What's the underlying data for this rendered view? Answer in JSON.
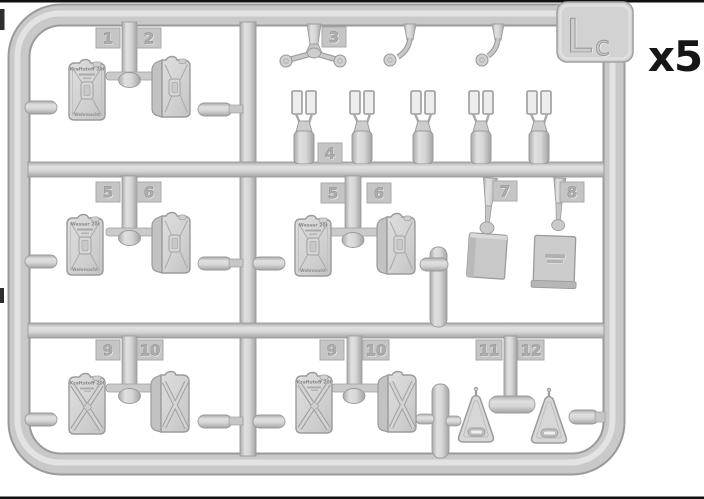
{
  "sprue": {
    "code_main": "L",
    "code_sub": "c",
    "multiplier": "x5"
  },
  "part_numbers": {
    "p1": "1",
    "p2": "2",
    "p3": "3",
    "p4": "4",
    "p5_left": "5",
    "p6_left": "6",
    "p5_center": "5",
    "p6_center": "6",
    "p7": "7",
    "p8": "8",
    "p9_left": "9",
    "p10_left": "10",
    "p9_center": "9",
    "p10_center": "10",
    "p11": "11",
    "p12": "12"
  },
  "can_labels": {
    "fuel": "Kraftstoff 20l",
    "water": "Wasser 20l",
    "brand": "Wehrmacht"
  },
  "colors": {
    "background": "#ffffff",
    "sprue_base": "#c9c9c9",
    "sprue_shadow": "#9a9a9a",
    "sprue_highlight": "#e3e3e3",
    "ink": "#161616"
  }
}
